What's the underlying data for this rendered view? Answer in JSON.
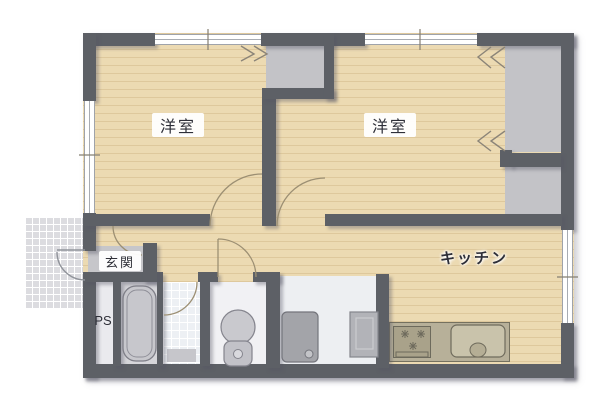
{
  "plan_title": "floor-plan",
  "rooms": [
    {
      "name": "bedroom-left",
      "label": "洋室"
    },
    {
      "name": "bedroom-right",
      "label": "洋室"
    },
    {
      "name": "kitchen",
      "label": "キッチン"
    },
    {
      "name": "entrance",
      "label": "玄関"
    },
    {
      "name": "pipe-space",
      "label": "PS"
    }
  ],
  "fixtures": [
    "bathtub",
    "toilet",
    "washing-machine",
    "kitchen-sink",
    "stove",
    "refrigerator-space",
    "closet-center",
    "closet-right-upper",
    "closet-right-lower",
    "entrance-porch",
    "bath-mat"
  ],
  "colors": {
    "background": "#ffffff",
    "wall": "#5d6066",
    "wood_floor": "#ecdab2",
    "closet_gray": "#c3c3c7",
    "entrance_gray": "#c6c6ca",
    "bath_floor": "#d6d6da",
    "washroom_tile": "#edf0f4",
    "toilet_floor": "#f1f1f4",
    "laundry_floor": "#edeff2",
    "ps_floor": "#eaeaee",
    "porch_tile": "#dcdce0",
    "counter": "#b7b099",
    "appliance_gray": "#a3a4a9",
    "door_arc": "#9c8f73"
  }
}
